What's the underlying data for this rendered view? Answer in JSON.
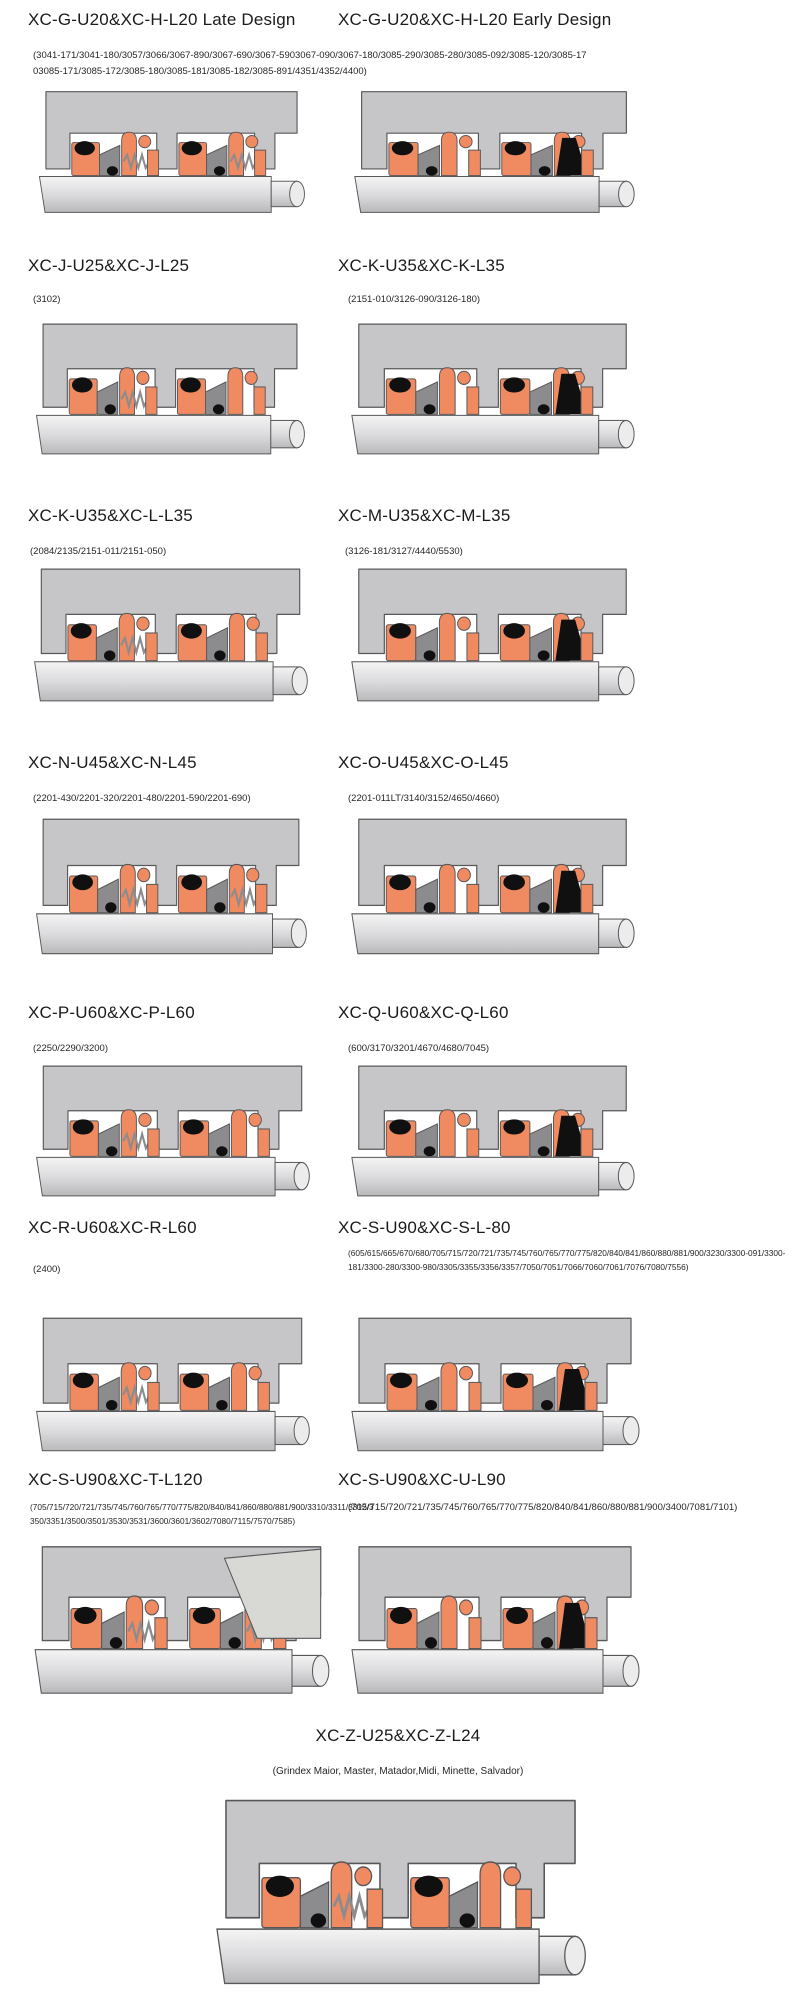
{
  "colors": {
    "housing": "#c6c6c8",
    "part_gray": "#8c8c8e",
    "seal_orange": "#f08a61",
    "oring_black": "#101010",
    "outline": "#58585a",
    "shaft_light": "#f4f4f5",
    "shaft_dark": "#b9b9bb",
    "text": "#1b1b1b"
  },
  "row1_models": "(3041-171/3041-180/3057/3066/3067-890/3067-690/3067-5903067-090/3067-180/3085-290/3085-280/3085-092/3085-120/3085-1703085-171/3085-172/3085-180/3085-181/3085-182/3085-891/4351/4352/4400)",
  "cells": [
    {
      "title": "XC-G-U20&XC-H-L20 Late Design"
    },
    {
      "title": "XC-G-U20&XC-H-L20 Early Design"
    },
    {
      "title": "XC-J-U25&XC-J-L25",
      "models": "(3102)"
    },
    {
      "title": "XC-K-U35&XC-K-L35",
      "models": "(2151-010/3126-090/3126-180)"
    },
    {
      "title": "XC-K-U35&XC-L-L35",
      "models": "(2084/2135/2151-011/2151-050)"
    },
    {
      "title": "XC-M-U35&XC-M-L35",
      "models": "(3126-181/3127/4440/5530)"
    },
    {
      "title": "XC-N-U45&XC-N-L45",
      "models": "(2201-430/2201-320/2201-480/2201-590/2201-690)"
    },
    {
      "title": "XC-O-U45&XC-O-L45",
      "models": "(2201-011LT/3140/3152/4650/4660)"
    },
    {
      "title": "XC-P-U60&XC-P-L60",
      "models": "(2250/2290/3200)"
    },
    {
      "title": "XC-Q-U60&XC-Q-L60",
      "models": "(600/3170/3201/4670/4680/7045)"
    },
    {
      "title": "XC-R-U60&XC-R-L60",
      "models": "(2400)"
    },
    {
      "title": "XC-S-U90&XC-S-L-80",
      "models": "(605/615/665/670/680/705/715/720/721/735/745/760/765/770/775/820/840/841/860/880/881/900/3230/3300-091/3300-181/3300-280/3300-980/3305/3355/3356/3357/7050/7051/7066/7060/7061/7076/7080/7556)"
    },
    {
      "title": "XC-S-U90&XC-T-L120",
      "models": "(705/715/720/721/735/745/760/765/770/775/820/840/841/860/880/881/900/3310/3311/3312/3350/3351/3500/3501/3530/3531/3600/3601/3602/7080/7115/7570/7585)"
    },
    {
      "title": "XC-S-U90&XC-U-L90",
      "models": "(705/715/720/721/735/745/760/765/770/775/820/840/841/860/880/881/900/3400/7081/7101)"
    },
    {
      "title": "XC-Z-U25&XC-Z-L24",
      "models": "(Grindex  Maior, Master, Matador,Midi, Minette, Salvador)"
    }
  ]
}
